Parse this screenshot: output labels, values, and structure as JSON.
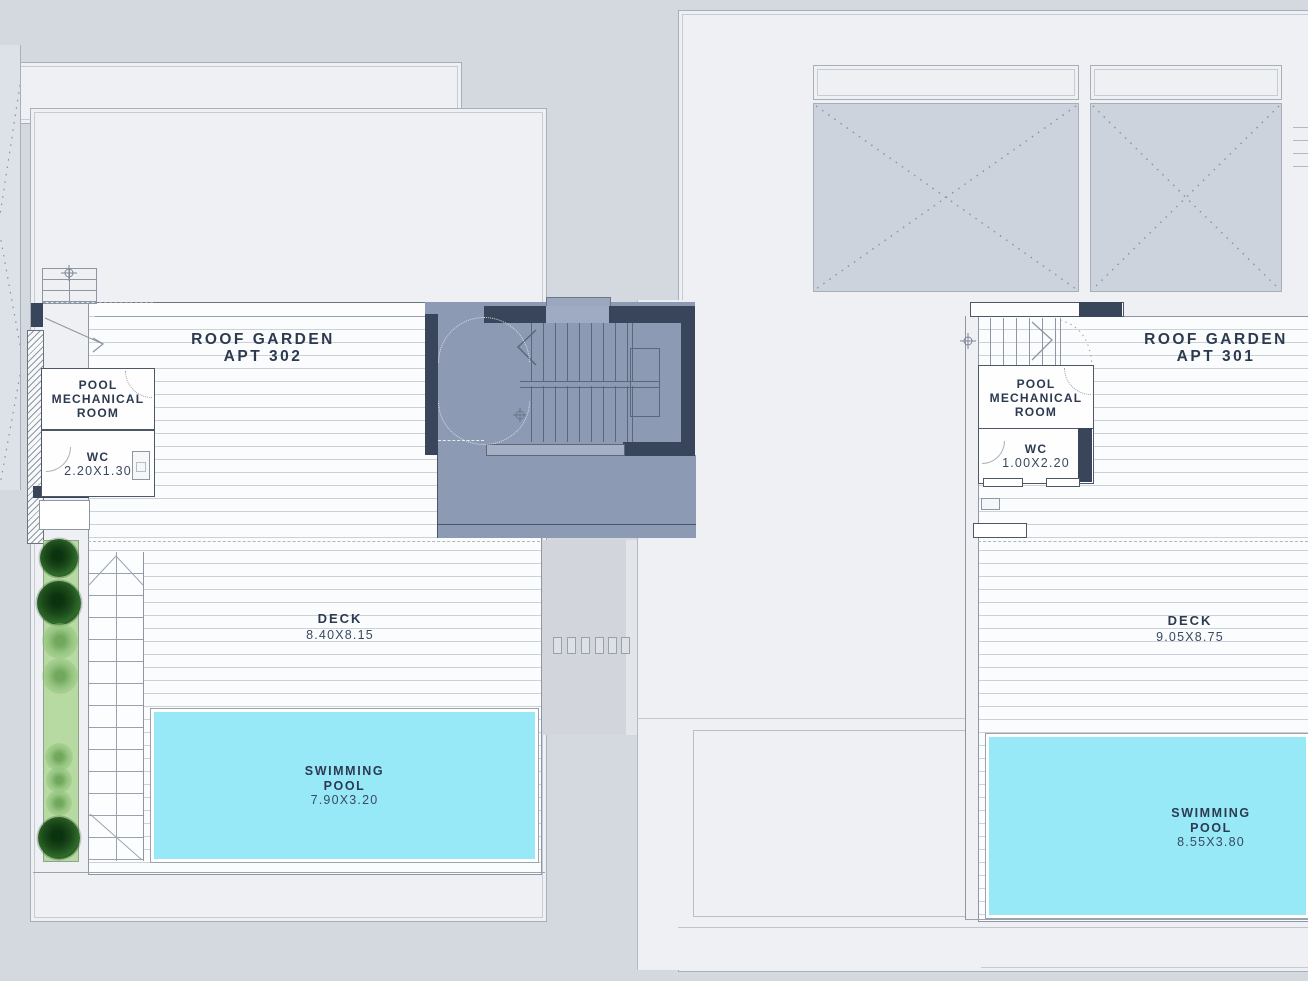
{
  "plan_type": "roof-garden-floor-plan",
  "apartments": [
    {
      "id": "apt-302",
      "roof_garden_label": "ROOF GARDEN",
      "apt_label": "APT 302",
      "pool_mech_label": "POOL\nMECHANICAL\nROOM",
      "wc_label": "WC",
      "wc_dim": "2.20X1.30",
      "deck_label": "DECK",
      "deck_dim": "8.40X8.15",
      "pool_label": "SWIMMING\nPOOL",
      "pool_dim": "7.90X3.20"
    },
    {
      "id": "apt-301",
      "roof_garden_label": "ROOF GARDEN",
      "apt_label": "APT 301",
      "pool_mech_label": "POOL\nMECHANICAL\nROOM",
      "wc_label": "WC",
      "wc_dim": "1.00X2.20",
      "deck_label": "DECK",
      "deck_dim": "9.05X8.75",
      "pool_label": "SWIMMING\nPOOL",
      "pool_dim": "8.55X3.80"
    }
  ],
  "colors": {
    "background": "#d4d8df",
    "panel": "#eef0f4",
    "panel_border": "#a9afb9",
    "deck_line": "#ccd1d8",
    "wall_dark": "#39455a",
    "stair_core": "#8c9ab4",
    "pool_water": "#97e9f8",
    "planter_green": "#b7d9a2",
    "tree_dark": "#1c4a1a",
    "tree_light": "#86bb70",
    "text": "#2c3a50"
  }
}
